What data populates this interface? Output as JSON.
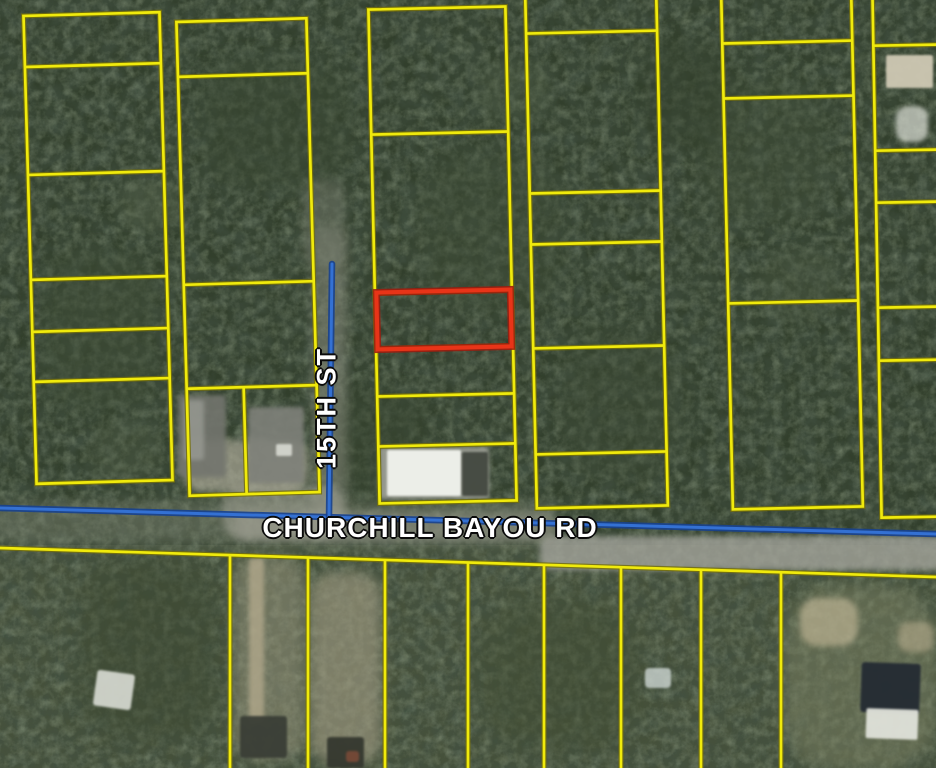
{
  "map": {
    "size": {
      "w": 936,
      "h": 768
    },
    "colors": {
      "parcel_line": "#f0ea0c",
      "parcel_line_edge": "#75700a",
      "selected_parcel_outline": "#e83418",
      "road_centerline": "#3471d3",
      "label_text": "#ffffff",
      "label_outline": "#0b0b0b",
      "forest_base": "#323f2c",
      "south_terrain_base": "#46513b"
    },
    "terrain": {
      "north_base": "#323f2c",
      "south_base": "#46513b",
      "south_top_y": 545
    },
    "roads": [
      {
        "id": "churchill-bayou-rd",
        "label": "CHURCHILL BAYOU RD",
        "orientation": "horizontal",
        "line": [
          [
            0,
            508
          ],
          [
            936,
            534
          ]
        ],
        "label_pos": {
          "x": 430,
          "y": 528
        }
      },
      {
        "id": "15th-st",
        "label": "15TH ST",
        "orientation": "vertical",
        "line": [
          [
            332,
            264
          ],
          [
            329,
            517
          ]
        ],
        "label_pos": {
          "x": 327,
          "y": 408
        }
      }
    ],
    "selected_parcel": {
      "x": 377,
      "y": 291,
      "w": 134,
      "h": 57,
      "rot": -1.3
    },
    "parcel_columns": [
      {
        "x": 30,
        "w": 136,
        "rot": -1.6,
        "rows": [
          14,
          65,
          173,
          278,
          330,
          380,
          482
        ]
      },
      {
        "x": 183,
        "w": 130,
        "rot": -1.6,
        "rows": [
          20,
          75,
          283,
          387,
          494
        ],
        "inner_v": [
          {
            "x": 240,
            "y1": 387,
            "y2": 494
          }
        ]
      },
      {
        "x": 374,
        "w": 137,
        "rot": -1.3,
        "rows": [
          8,
          133,
          292,
          347,
          395,
          445,
          502
        ]
      },
      {
        "x": 531,
        "w": 131,
        "rot": -1.3,
        "rows": [
          -8,
          32,
          192,
          243,
          347,
          453,
          507
        ]
      },
      {
        "x": 727,
        "w": 130,
        "rot": -1.3,
        "rows": [
          -8,
          42,
          97,
          302,
          508
        ]
      },
      {
        "x": 877,
        "w": 78,
        "rot": -1.0,
        "rows": [
          -8,
          45,
          150,
          202,
          307,
          360,
          517
        ]
      }
    ],
    "south_block": {
      "top_left_y": 548,
      "top_right_y": 577,
      "verticals": [
        230,
        308,
        385,
        468,
        544,
        621,
        701,
        781
      ]
    },
    "patches": [
      {
        "x": 40,
        "y": 250,
        "w": 120,
        "h": 160,
        "fill": "#3e4c36",
        "op": 0.5,
        "blur": 10
      },
      {
        "x": 200,
        "y": 60,
        "w": 150,
        "h": 130,
        "fill": "#3a4833",
        "op": 0.5,
        "blur": 10
      },
      {
        "x": 420,
        "y": 150,
        "w": 140,
        "h": 160,
        "fill": "#404e38",
        "op": 0.45,
        "blur": 12
      },
      {
        "x": 560,
        "y": 330,
        "w": 120,
        "h": 150,
        "fill": "#3d4a35",
        "op": 0.45,
        "blur": 12
      },
      {
        "x": 700,
        "y": 80,
        "w": 130,
        "h": 140,
        "fill": "#42503a",
        "op": 0.4,
        "blur": 12
      },
      {
        "x": 80,
        "y": 560,
        "w": 140,
        "h": 180,
        "fill": "#3c4831",
        "op": 0.5,
        "blur": 12
      },
      {
        "x": 480,
        "y": 600,
        "w": 160,
        "h": 150,
        "fill": "#414d33",
        "op": 0.5,
        "blur": 12
      },
      {
        "x": 640,
        "y": 40,
        "w": 90,
        "h": 110,
        "fill": "#35422e",
        "op": 0.5,
        "blur": 10
      },
      {
        "x": 330,
        "y": 390,
        "w": 100,
        "h": 110,
        "fill": "#37442f",
        "op": 0.5,
        "blur": 10
      },
      {
        "x": 120,
        "y": 180,
        "w": 60,
        "h": 50,
        "fill": "#55624a",
        "op": 0.4,
        "blur": 6
      },
      {
        "x": 480,
        "y": 60,
        "w": 70,
        "h": 60,
        "fill": "#4f5d45",
        "op": 0.35,
        "blur": 6
      },
      {
        "x": 760,
        "y": 250,
        "w": 80,
        "h": 70,
        "fill": "#4e5b44",
        "op": 0.35,
        "blur": 6
      },
      {
        "x": 90,
        "y": 420,
        "w": 70,
        "h": 60,
        "fill": "#515e47",
        "op": 0.35,
        "blur": 6
      },
      {
        "x": 313,
        "y": 228,
        "w": 34,
        "h": 310,
        "fill": "#8f9183",
        "op": 0.5,
        "blur": 5
      },
      {
        "x": -10,
        "y": 502,
        "w": 570,
        "h": 42,
        "fill": "#7d8472",
        "op": 0.45,
        "blur": 6
      },
      {
        "x": 540,
        "y": 536,
        "w": 406,
        "h": 34,
        "fill": "#a8a8a0",
        "op": 0.75,
        "blur": 3
      },
      {
        "x": 235,
        "y": 512,
        "w": 320,
        "h": 30,
        "fill": "#98988c",
        "op": 0.5,
        "blur": 4
      },
      {
        "x": 222,
        "y": 486,
        "w": 122,
        "h": 52,
        "fill": "#a3a396",
        "op": 0.55,
        "blur": 4
      },
      {
        "x": 303,
        "y": 180,
        "w": 42,
        "h": 85,
        "fill": "#6e7566",
        "op": 0.55,
        "blur": 5
      },
      {
        "x": 183,
        "y": 440,
        "w": 125,
        "h": 52,
        "fill": "#b3af9e",
        "op": 0.65,
        "blur": 4
      },
      {
        "x": 178,
        "y": 395,
        "w": 48,
        "h": 82,
        "fill": "#73756e",
        "op": 0.9,
        "blur": 2,
        "rx": 3
      },
      {
        "x": 184,
        "y": 400,
        "w": 20,
        "h": 60,
        "fill": "#9ea099",
        "op": 0.7,
        "blur": 2,
        "rx": 3
      },
      {
        "x": 248,
        "y": 407,
        "w": 56,
        "h": 76,
        "fill": "#7f817a",
        "op": 0.9,
        "blur": 2,
        "rx": 3
      },
      {
        "x": 276,
        "y": 444,
        "w": 16,
        "h": 12,
        "fill": "#d8dad2",
        "op": 0.9,
        "blur": 1,
        "rx": 2
      },
      {
        "x": 379,
        "y": 447,
        "w": 110,
        "h": 52,
        "fill": "#9fa198",
        "op": 0.9,
        "blur": 2,
        "rx": 3
      },
      {
        "x": 387,
        "y": 450,
        "w": 74,
        "h": 46,
        "fill": "#eceee8",
        "op": 1,
        "blur": 1,
        "rx": 2
      },
      {
        "x": 462,
        "y": 452,
        "w": 26,
        "h": 44,
        "fill": "#3f443c",
        "op": 0.9,
        "blur": 1,
        "rx": 2
      },
      {
        "x": 886,
        "y": 55,
        "w": 47,
        "h": 33,
        "fill": "#cfc9b4",
        "op": 0.95,
        "blur": 1,
        "rx": 2
      },
      {
        "x": 896,
        "y": 106,
        "w": 32,
        "h": 36,
        "fill": "#dcdfd6",
        "op": 0.7,
        "blur": 2
      },
      {
        "x": 233,
        "y": 556,
        "w": 72,
        "h": 205,
        "fill": "#9a977f",
        "op": 0.5,
        "blur": 6
      },
      {
        "x": 249,
        "y": 558,
        "w": 15,
        "h": 165,
        "fill": "#b5ab8e",
        "op": 0.75,
        "blur": 2,
        "rx": 4
      },
      {
        "x": 310,
        "y": 572,
        "w": 72,
        "h": 192,
        "fill": "#a49e85",
        "op": 0.6,
        "blur": 6
      },
      {
        "x": 783,
        "y": 585,
        "w": 155,
        "h": 185,
        "fill": "#7b8163",
        "op": 0.5,
        "blur": 7
      },
      {
        "x": 800,
        "y": 598,
        "w": 58,
        "h": 48,
        "fill": "#c9bd9c",
        "op": 0.6,
        "blur": 3
      },
      {
        "x": 898,
        "y": 622,
        "w": 36,
        "h": 30,
        "fill": "#bdb191",
        "op": 0.55,
        "blur": 3
      },
      {
        "x": 240,
        "y": 716,
        "w": 47,
        "h": 42,
        "fill": "#3a3e36",
        "op": 0.95,
        "blur": 1,
        "rx": 3
      },
      {
        "x": 327,
        "y": 737,
        "w": 37,
        "h": 31,
        "fill": "#35382f",
        "op": 0.95,
        "blur": 1,
        "rx": 3
      },
      {
        "x": 346,
        "y": 751,
        "w": 13,
        "h": 11,
        "fill": "#7d4b38",
        "op": 0.85,
        "blur": 1,
        "rx": 3
      },
      {
        "x": 95,
        "y": 672,
        "w": 38,
        "h": 36,
        "fill": "#d9dcd4",
        "op": 0.9,
        "blur": 1,
        "rx": 3,
        "rot": 8
      },
      {
        "x": 861,
        "y": 663,
        "w": 59,
        "h": 50,
        "fill": "#242b33",
        "op": 0.95,
        "blur": 1,
        "rx": 3,
        "rot": 2
      },
      {
        "x": 866,
        "y": 709,
        "w": 52,
        "h": 30,
        "fill": "#e0e2da",
        "op": 0.95,
        "blur": 1,
        "rx": 2,
        "rot": 2
      },
      {
        "x": 645,
        "y": 668,
        "w": 26,
        "h": 20,
        "fill": "#ccd5d1",
        "op": 0.8,
        "blur": 1,
        "rx": 4
      }
    ]
  }
}
